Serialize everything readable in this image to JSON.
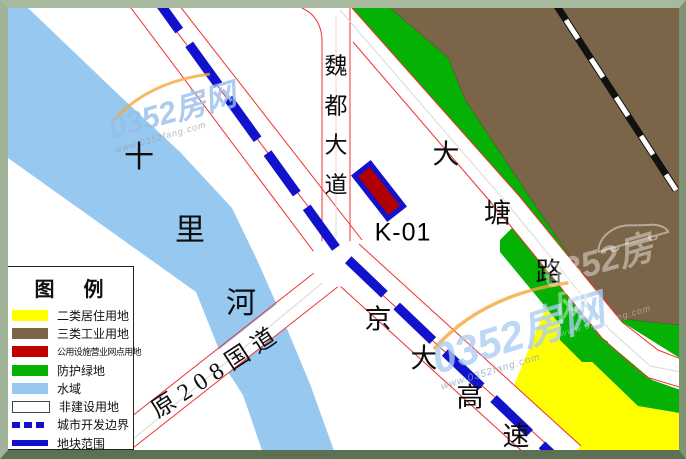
{
  "map": {
    "labels": {
      "river": "十里河",
      "weidu_avenue": "魏都大道",
      "datang_road": "大塘路",
      "jingda_expressway": "京大高速",
      "old_g208": "原208国道",
      "parcel_code": "K-01"
    }
  },
  "legend": {
    "title": "图 例",
    "items": [
      {
        "label": "二类居住用地",
        "color": "#ffff00",
        "type": "fill"
      },
      {
        "label": "三类工业用地",
        "color": "#7b6548",
        "type": "fill"
      },
      {
        "label": "公用设施营业网点用地",
        "color": "#c00000",
        "type": "fill"
      },
      {
        "label": "防护绿地",
        "color": "#04b104",
        "type": "fill"
      },
      {
        "label": "水域",
        "color": "#97c8f0",
        "type": "fill"
      },
      {
        "label": "非建设用地",
        "color": "#ffffff",
        "type": "fill"
      },
      {
        "label": "城市开发边界",
        "color": "#1212cc",
        "type": "dashed-line"
      },
      {
        "label": "地块范围",
        "color": "#1212cc",
        "type": "solid-line"
      }
    ]
  },
  "watermark": {
    "brand": "0352房网",
    "url": "www.0352fang.com"
  },
  "colors": {
    "water": "#97c8f0",
    "greenbelt": "#04b104",
    "industrial_brown": "#7b6548",
    "residential_yellow": "#ffff00",
    "parcel_red": "#b00000",
    "boundary_blue": "#1212cc",
    "road_edge_red": "#f03030",
    "railway_black": "#111111"
  }
}
